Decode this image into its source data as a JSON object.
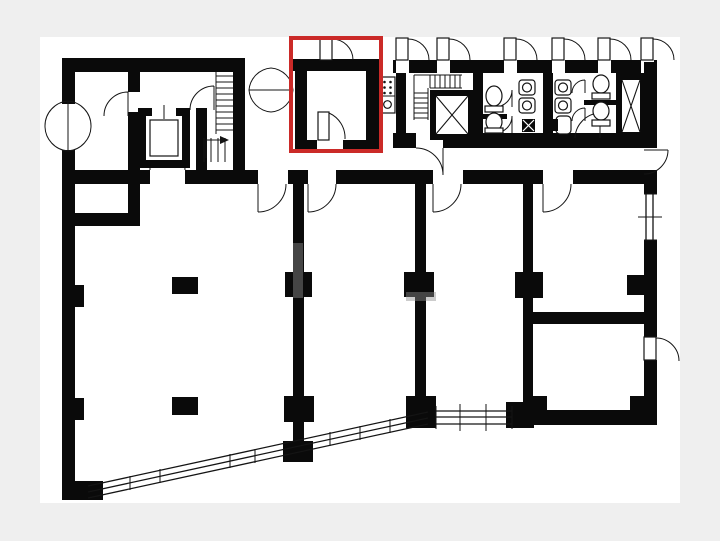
{
  "document": {
    "kind": "architectural-floor-plan",
    "visible_text": "",
    "notes_on_screen": ""
  },
  "colors": {
    "margin": "#efefef",
    "paper": "#ffffff",
    "wall": "#0a0a0a",
    "highlight": "#cb2a28",
    "watermark": "#8f8f8f"
  },
  "highlight": {
    "shape": "rectangle",
    "x": 291,
    "y": 38,
    "width": 90,
    "height": 113,
    "stroke_width": 4
  },
  "plan": {
    "highlighted_room": {
      "label": "",
      "outlined": true
    },
    "fixtures": [
      {
        "name": "entrance-double-swing-door",
        "symbol": "butterfly-door"
      },
      {
        "name": "lobby-double-swing-door",
        "symbol": "butterfly-door"
      },
      {
        "name": "main-staircase",
        "symbol": "stair-treads-with-arrow"
      },
      {
        "name": "passenger-elevator",
        "symbol": "boxed-car"
      },
      {
        "name": "service-staircase",
        "symbol": "l-shaped-stair"
      },
      {
        "name": "service-elevator",
        "symbol": "x-box"
      },
      {
        "name": "utility-shaft",
        "symbol": "x-box"
      },
      {
        "name": "toilet",
        "count": 4
      },
      {
        "name": "washbasin",
        "count": 4
      },
      {
        "name": "urinal",
        "count": 1
      },
      {
        "name": "floor-drain",
        "symbol": "x-square"
      },
      {
        "name": "kitchenette",
        "symbol": "stove-and-sink"
      },
      {
        "name": "diagonal-window-band",
        "symbol": "double-line-glazing"
      },
      {
        "name": "window-band-south",
        "symbol": "double-line-glazing"
      },
      {
        "name": "window-east",
        "symbol": "double-line-glazing"
      },
      {
        "name": "structural-columns",
        "count": 8
      },
      {
        "name": "door-swing",
        "count": 18
      }
    ]
  }
}
